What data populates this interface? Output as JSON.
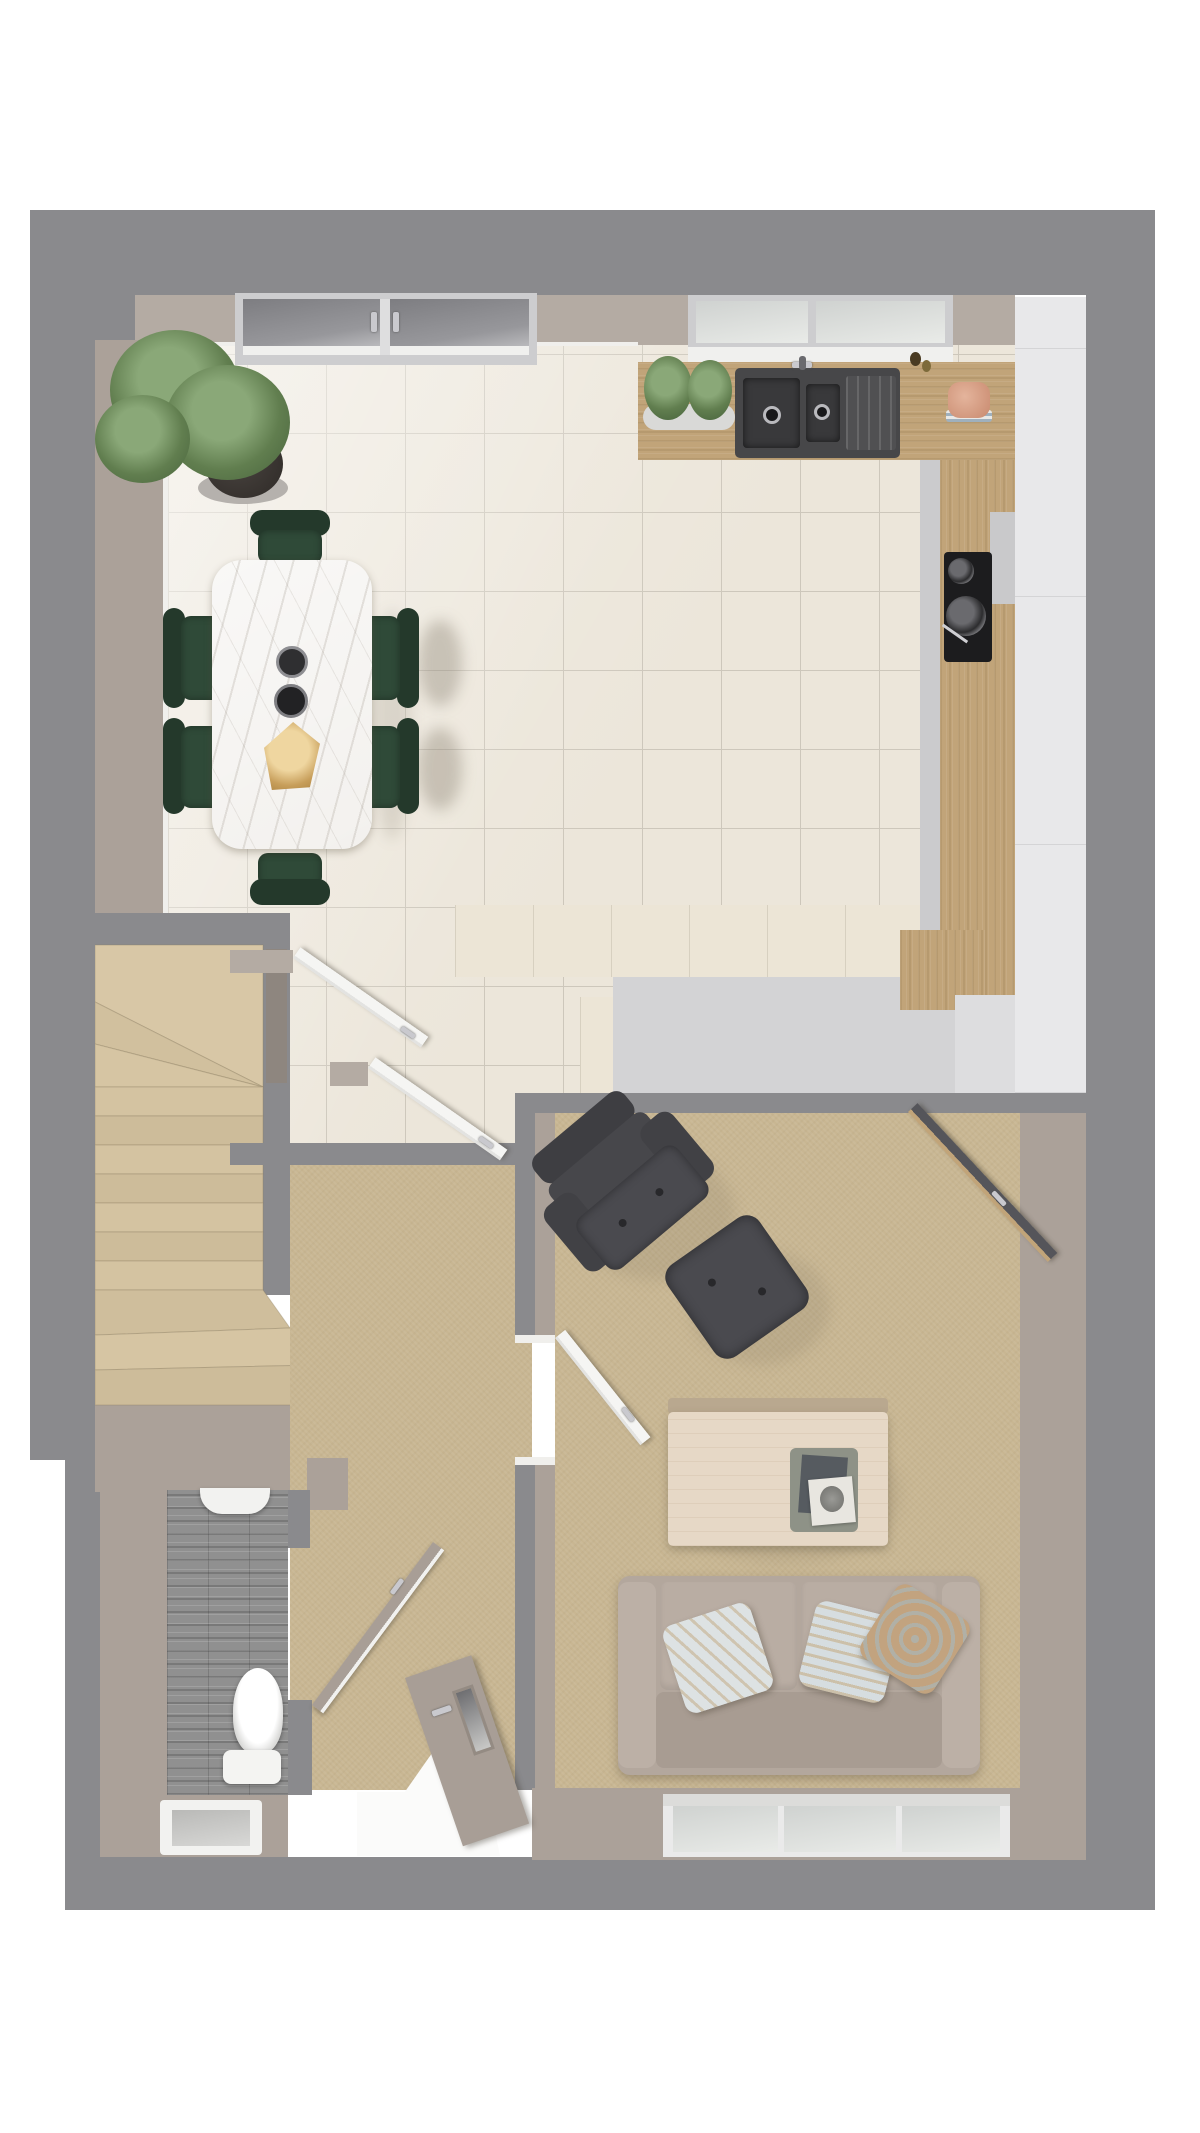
{
  "meta": {
    "title": "Ground floor plan – 3D top-down render",
    "view": "dollhouse top view",
    "floor": "ground"
  },
  "palette": {
    "page_bg": "#ffffff",
    "outer_wall": "#8a8a8d",
    "wall_face": "#aba199",
    "wall_face_light": "#b4aba3",
    "tile": "#ece6da",
    "grout": "#cdc7bb",
    "carpet": "#c8b692",
    "stairs_carpet": "#d5c4a2",
    "planks": "#909090",
    "wood": "#c1a479",
    "cream": "#ece5d6",
    "worktop": "#d3d3d5",
    "units": "#e8e8ea",
    "sink": "#474749",
    "marble": "#f3f1ee",
    "green": "#2f4a38",
    "green_dark": "#24392b",
    "sofa": "#b3a79d",
    "dark_leather": "#48484c",
    "table_wood": "#e6d8c6",
    "door_taupe": "#a89e96",
    "frame": "#cdcdcf",
    "gold": "#c79e5a",
    "peach": "#d59a82",
    "plant_green": "#7b9a6a"
  },
  "items": {
    "plan": "Ground floor plan 3D render",
    "kitchen_dining": "Open-plan kitchen and dining room with cream floor tiles",
    "living_room": "Carpeted living room",
    "hall": "Entrance hallway",
    "wc": "Cloakroom WC with grey plank floor",
    "stairs": "Carpeted winder staircase",
    "dining_table": "White marble dining table",
    "dining_chair": "Dark green velvet dining chair",
    "plant": "Large potted plant",
    "herb_pots": "Herb pots on worktop",
    "sink": "Dark composite 1.5-bowl sink with drainer",
    "hob": "Black hob with pans",
    "worktop_wood": "Oak worktop",
    "base_cabinets": "Cream gloss base cabinets",
    "tall_units": "Light grey tall units",
    "peach_bowl": "Peach bowl on stacked plates",
    "sofa": "Two-seat greige sofa with patterned cushions",
    "armchair": "Charcoal lounge chair",
    "ottoman": "Charcoal footstool",
    "coffee_table": "Light wood coffee table with magazine tray",
    "toilet": "Toilet",
    "basin": "Wash basin",
    "french_doors": "Glazed French doors",
    "kitchen_window": "Kitchen window over sink",
    "living_window": "Living room triple window",
    "wc_window": "WC window",
    "kitchen_door": "Glazed door from kitchen to living room",
    "hall_door_1": "White door from hall to dining area",
    "hall_door_2": "White door from hall to kitchen",
    "living_door": "White door from hall to living room",
    "wc_door": "WC door",
    "front_door": "Front door (open)"
  }
}
